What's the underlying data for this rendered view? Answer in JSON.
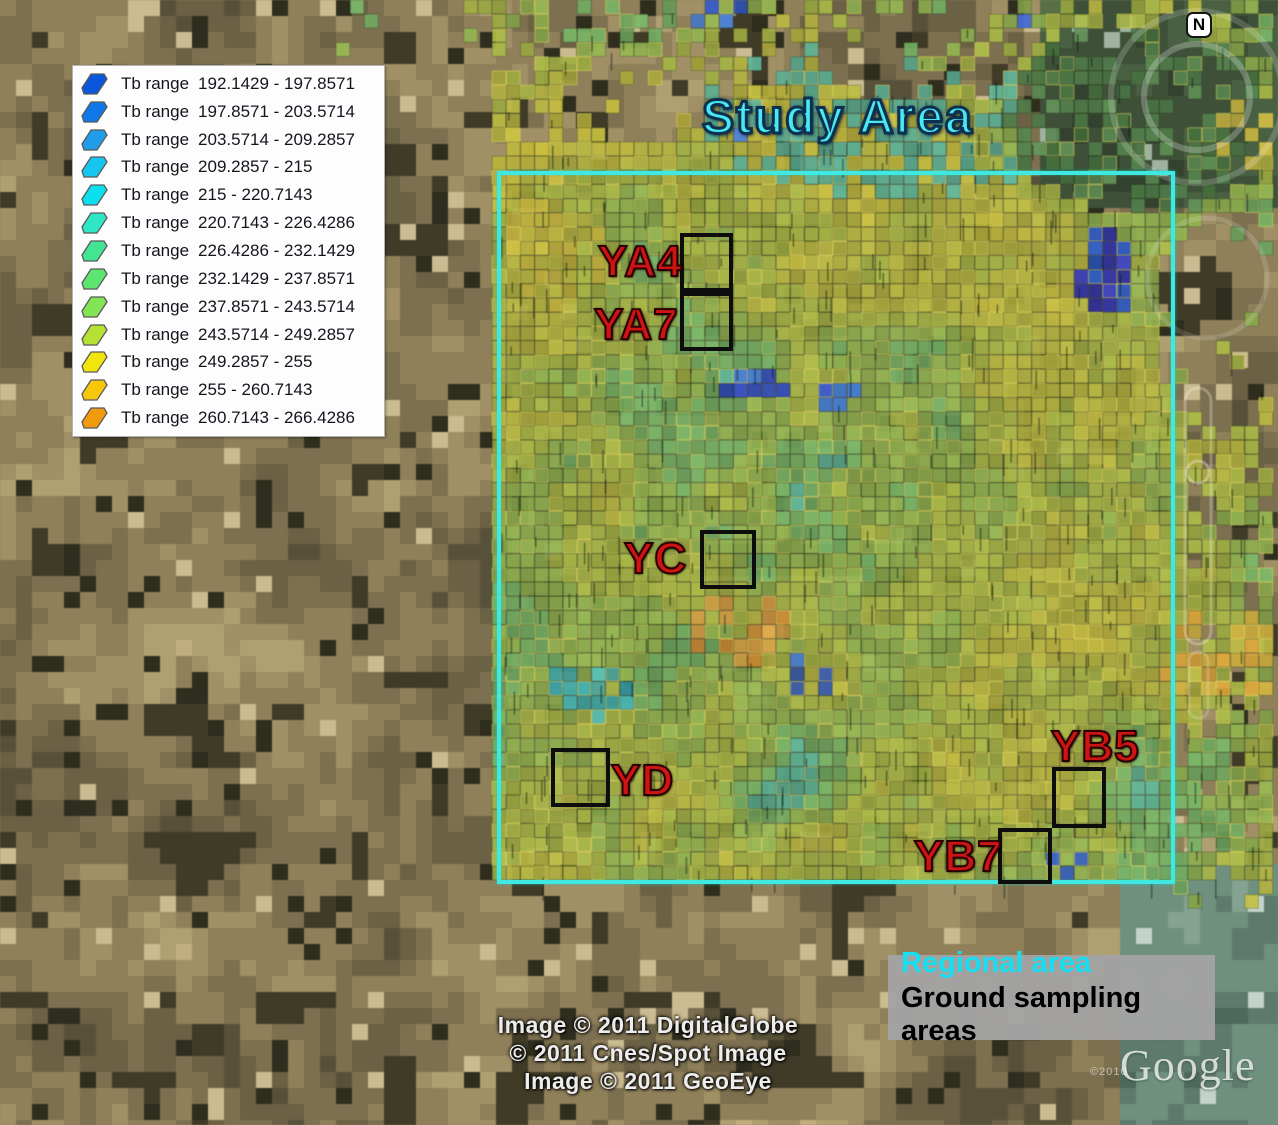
{
  "map": {
    "study_area_label": "Study Area",
    "compass_label": "N",
    "regional_area_box": {
      "x": 497,
      "y": 171,
      "w": 678,
      "h": 713
    },
    "regional_area_color": "#3fe8e0",
    "sampling_box_color": "#0d0d0d",
    "site_label_color": "#cf1414",
    "sampling_sites": [
      {
        "id": "YA4",
        "box": {
          "x": 680,
          "y": 233,
          "w": 53,
          "h": 59
        },
        "label_pos": {
          "x": 598,
          "y": 237
        }
      },
      {
        "id": "YA7",
        "box": {
          "x": 680,
          "y": 292,
          "w": 53,
          "h": 59
        },
        "label_pos": {
          "x": 594,
          "y": 300
        }
      },
      {
        "id": "YC",
        "box": {
          "x": 700,
          "y": 530,
          "w": 56,
          "h": 59
        },
        "label_pos": {
          "x": 624,
          "y": 534
        }
      },
      {
        "id": "YD",
        "box": {
          "x": 551,
          "y": 748,
          "w": 59,
          "h": 59
        },
        "label_pos": {
          "x": 611,
          "y": 756
        }
      },
      {
        "id": "YB5",
        "box": {
          "x": 1052,
          "y": 767,
          "w": 54,
          "h": 61
        },
        "label_pos": {
          "x": 1051,
          "y": 722
        }
      },
      {
        "id": "YB7",
        "box": {
          "x": 998,
          "y": 828,
          "w": 54,
          "h": 56
        },
        "label_pos": {
          "x": 914,
          "y": 832
        }
      }
    ]
  },
  "legend": {
    "label_prefix": "Tb range",
    "entries": [
      {
        "range": "192.1429 - 197.8571",
        "color": "#0a56dc"
      },
      {
        "range": "197.8571 - 203.5714",
        "color": "#0d78e6"
      },
      {
        "range": "203.5714 - 209.2857",
        "color": "#219ce8"
      },
      {
        "range": "209.2857 - 215",
        "color": "#17c6ee"
      },
      {
        "range": "215 - 220.7143",
        "color": "#0edfee"
      },
      {
        "range": "220.7143 - 226.4286",
        "color": "#2ee5c6"
      },
      {
        "range": "226.4286 - 232.1429",
        "color": "#43e593"
      },
      {
        "range": "232.1429 - 237.8571",
        "color": "#5ce66f"
      },
      {
        "range": "237.8571 - 243.5714",
        "color": "#83e455"
      },
      {
        "range": "243.5714 - 249.2857",
        "color": "#b5e232"
      },
      {
        "range": "249.2857 - 255",
        "color": "#f2e50c"
      },
      {
        "range": "255 - 260.7143",
        "color": "#f7c70a"
      },
      {
        "range": "260.7143 - 266.4286",
        "color": "#f29a0e"
      }
    ]
  },
  "attribution": {
    "lines": [
      "Image © 2011 DigitalGlobe",
      "© 2011 Cnes/Spot Image",
      "Image © 2011 GeoEye"
    ]
  },
  "annotation_box": {
    "regional_label": "Regional area",
    "regional_color": "#17dff2",
    "ground_label": "Ground sampling areas",
    "ground_color": "#000000",
    "background": "#a3a3a3"
  },
  "watermark": {
    "logo": "Google",
    "year": "©2010"
  }
}
